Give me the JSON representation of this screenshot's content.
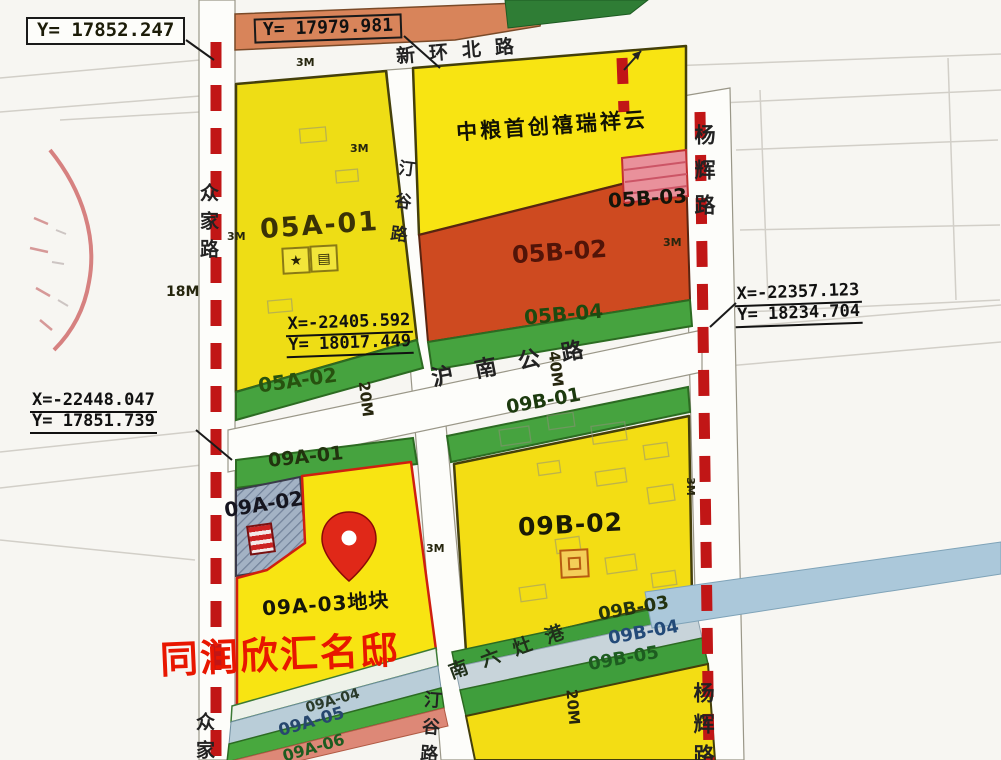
{
  "coordinates": {
    "c1": {
      "l1": "Y= 17852.247"
    },
    "c2": {
      "l1": "Y= 17979.981"
    },
    "c3": {
      "l1": "X=-22405.592",
      "l2": "Y= 18017.449"
    },
    "c4": {
      "l1": "X=-22357.123",
      "l2": "Y= 18234.704"
    },
    "c5": {
      "l1": "X=-22448.047",
      "l2": "Y= 17851.739"
    }
  },
  "roads": {
    "xinhuanbei": "新环北路",
    "hunan": "沪南公路",
    "tinggu": "汀谷路",
    "zhongjia": "众家路",
    "yanghui": "杨辉路",
    "nanliuzao": "南六灶港"
  },
  "parcels": {
    "a0501": "05A-01",
    "a0502": "05A-02",
    "b0502": "05B-02",
    "b0503": "05B-03",
    "b0504": "05B-04",
    "a0901": "09A-01",
    "a0902": "09A-02",
    "a0903_plot": "09A-03地块",
    "a0904": "09A-04",
    "a0905": "09A-05",
    "a0906": "09A-06",
    "b0901": "09B-01",
    "b0902": "09B-02",
    "b0903": "09B-03",
    "b0904": "09B-04",
    "b0905": "09B-05"
  },
  "annotations": {
    "project_north": "中粮首创禧瑞祥云",
    "residence": "同润欣汇名邸"
  },
  "dimensions": {
    "d3a": "3M",
    "d3b": "3M",
    "d3c": "3M",
    "d3d": "3M",
    "d3e": "3M",
    "d3f": "3M",
    "d18": "18M",
    "d20a": "20M",
    "d20b": "20M",
    "d40": "40M"
  },
  "colors": {
    "parcel_yellow": "#f6e112",
    "parcel_red": "#ce4a20",
    "strip_green": "#46a33f",
    "water_blue": "#abc8da",
    "boundary_red": "#c11616",
    "highlight_red_text": "#e81600",
    "road_orange": "#d8845a"
  }
}
